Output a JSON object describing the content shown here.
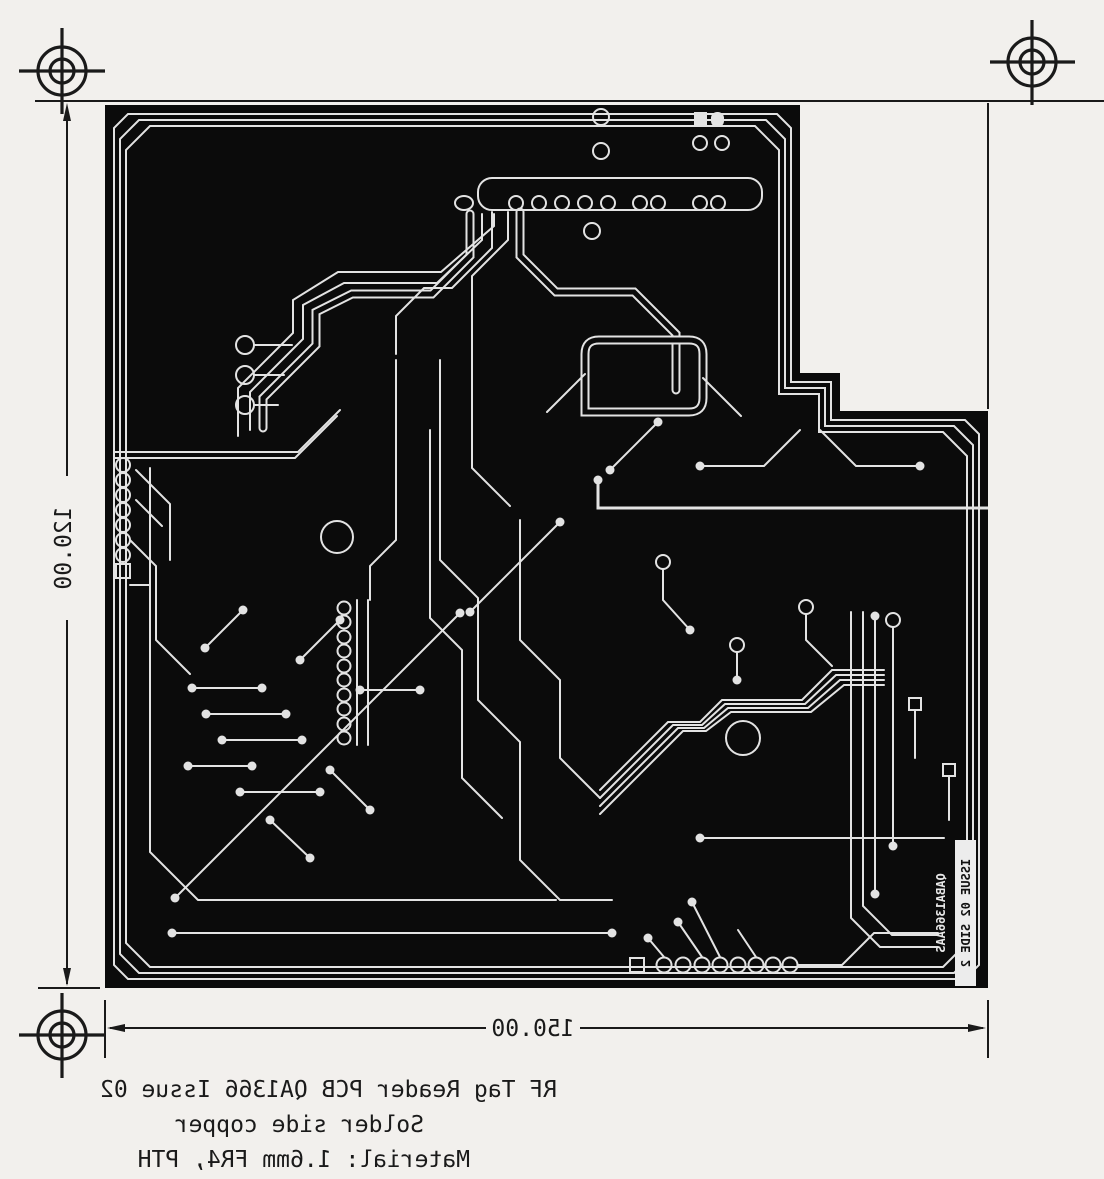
{
  "drawing": {
    "kind": "pcb-photoplot-scan",
    "colors": {
      "paper": "#f2f0ed",
      "ink": "#1a1a1a",
      "copper_pour": "#0b0b0b",
      "trace": "#e3e3e3"
    },
    "dimensions": {
      "board_width_label": "150.00",
      "board_height_label": "120.00"
    },
    "artwork_labels": {
      "issue_box": "ISSUE 02 SIDE 2",
      "film_id": "QABA1366AAS"
    },
    "title_block": {
      "line1": "RF Tag Reader PCB QA1366 Issue 02",
      "line2": "Solder side copper",
      "line3": "Material:  1.6mm FR4, PTH"
    }
  }
}
